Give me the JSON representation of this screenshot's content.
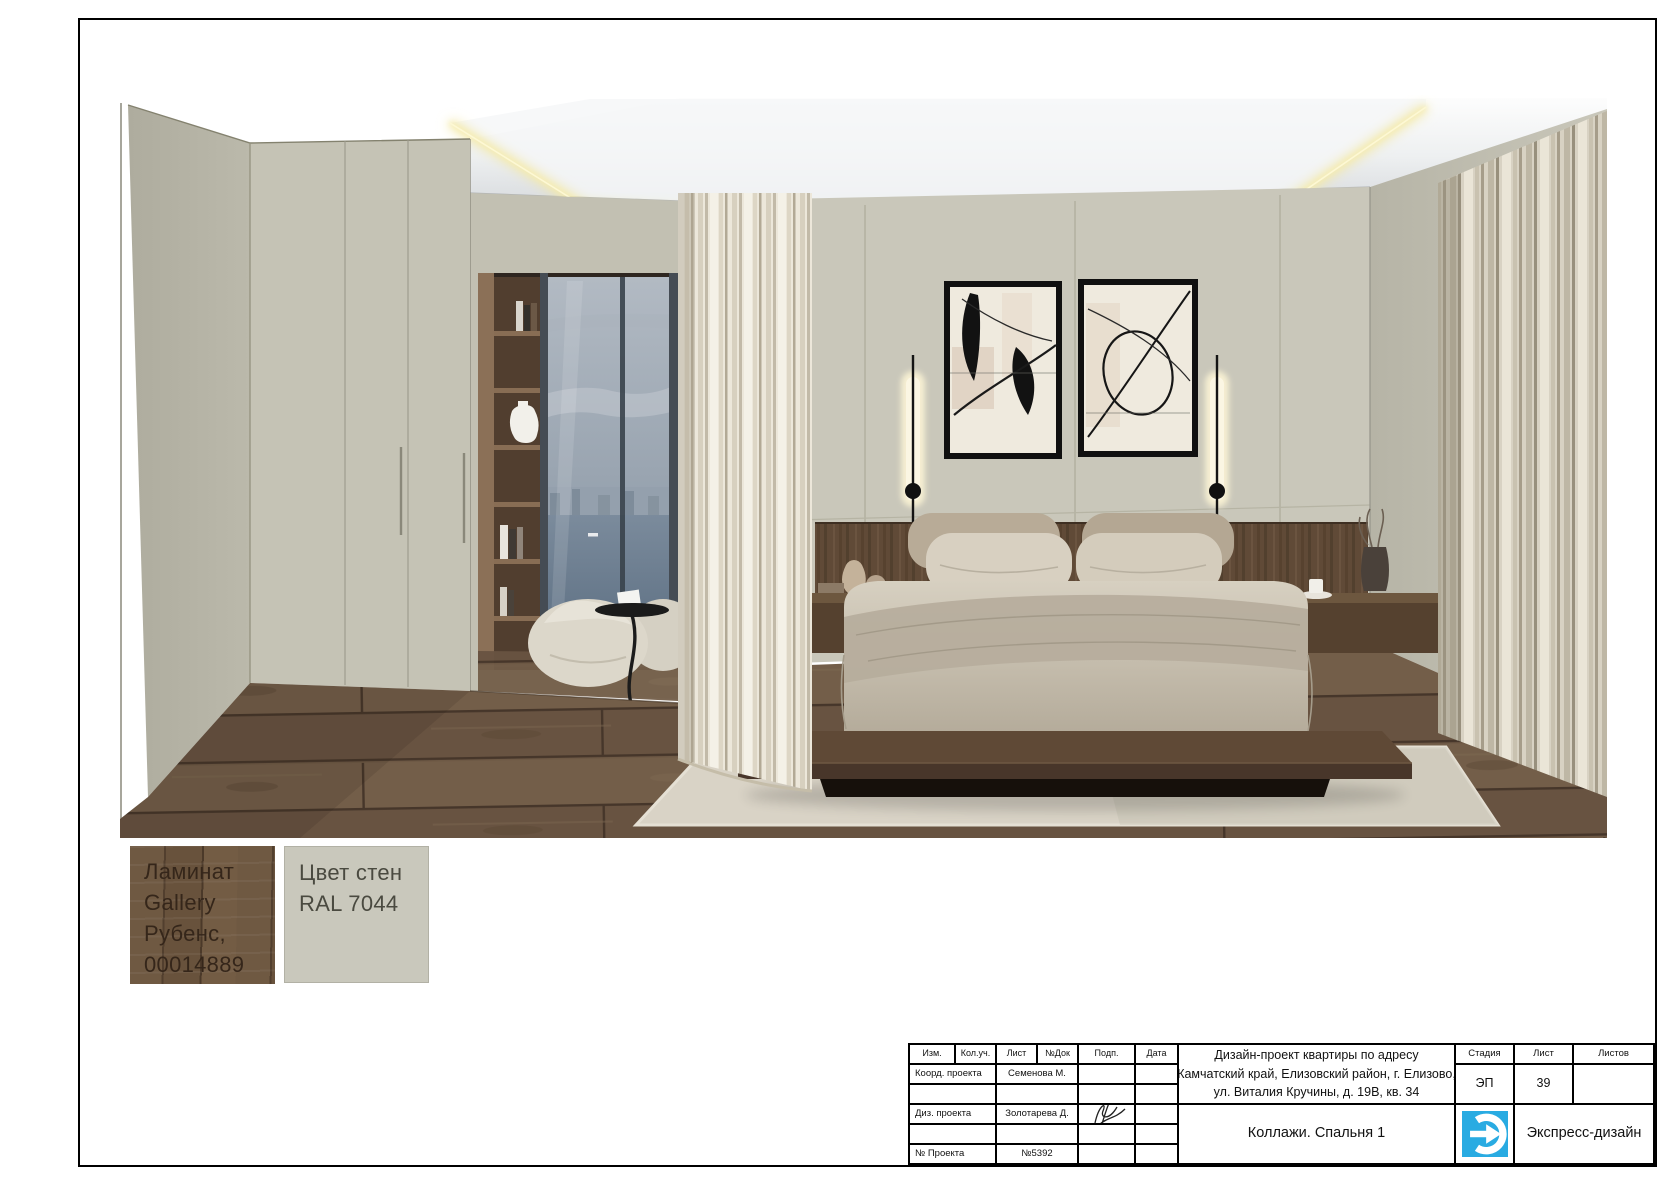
{
  "page": {
    "frame_color": "#000000",
    "background": "#ffffff"
  },
  "scene": {
    "name": "bedroom-interior-collage",
    "wall_paint_hex": "#c8c6b9",
    "laminate_hex": "#6e5945",
    "cove_glow_hex": "#f6ecae"
  },
  "materials": {
    "laminate": {
      "lines": [
        "Ламинат",
        "Gallery",
        "Рубенс,",
        "00014889"
      ]
    },
    "wall_paint": {
      "lines": [
        "Цвет стен",
        "RAL 7044"
      ]
    }
  },
  "title_block": {
    "cols": {
      "izm": "Изм.",
      "koluch": "Кол.уч.",
      "list": "Лист",
      "ndok": "№Док",
      "podp": "Подп.",
      "data": "Дата"
    },
    "roles": {
      "coord": "Коорд. проекта",
      "diz": "Диз. проекта",
      "num": "№ Проекта"
    },
    "names": {
      "coord": "Семенова М.",
      "diz": "Золотарева Д.",
      "num": "№5392"
    },
    "project": {
      "line1": "Дизайн-проект квартиры по адресу",
      "line2": "Камчатский край, Елизовский район, г. Елизово,",
      "line3": "ул. Виталия Кручины, д. 19В, кв. 34"
    },
    "stage": {
      "label": "Стадия",
      "value": "ЭП"
    },
    "sheet": {
      "label": "Лист",
      "value": "39"
    },
    "sheets": {
      "label": "Листов",
      "value": ""
    },
    "drawing_title": "Коллажи. Спальня 1",
    "company": "Экспресс-дизайн",
    "logo_color": "#29abe2"
  }
}
